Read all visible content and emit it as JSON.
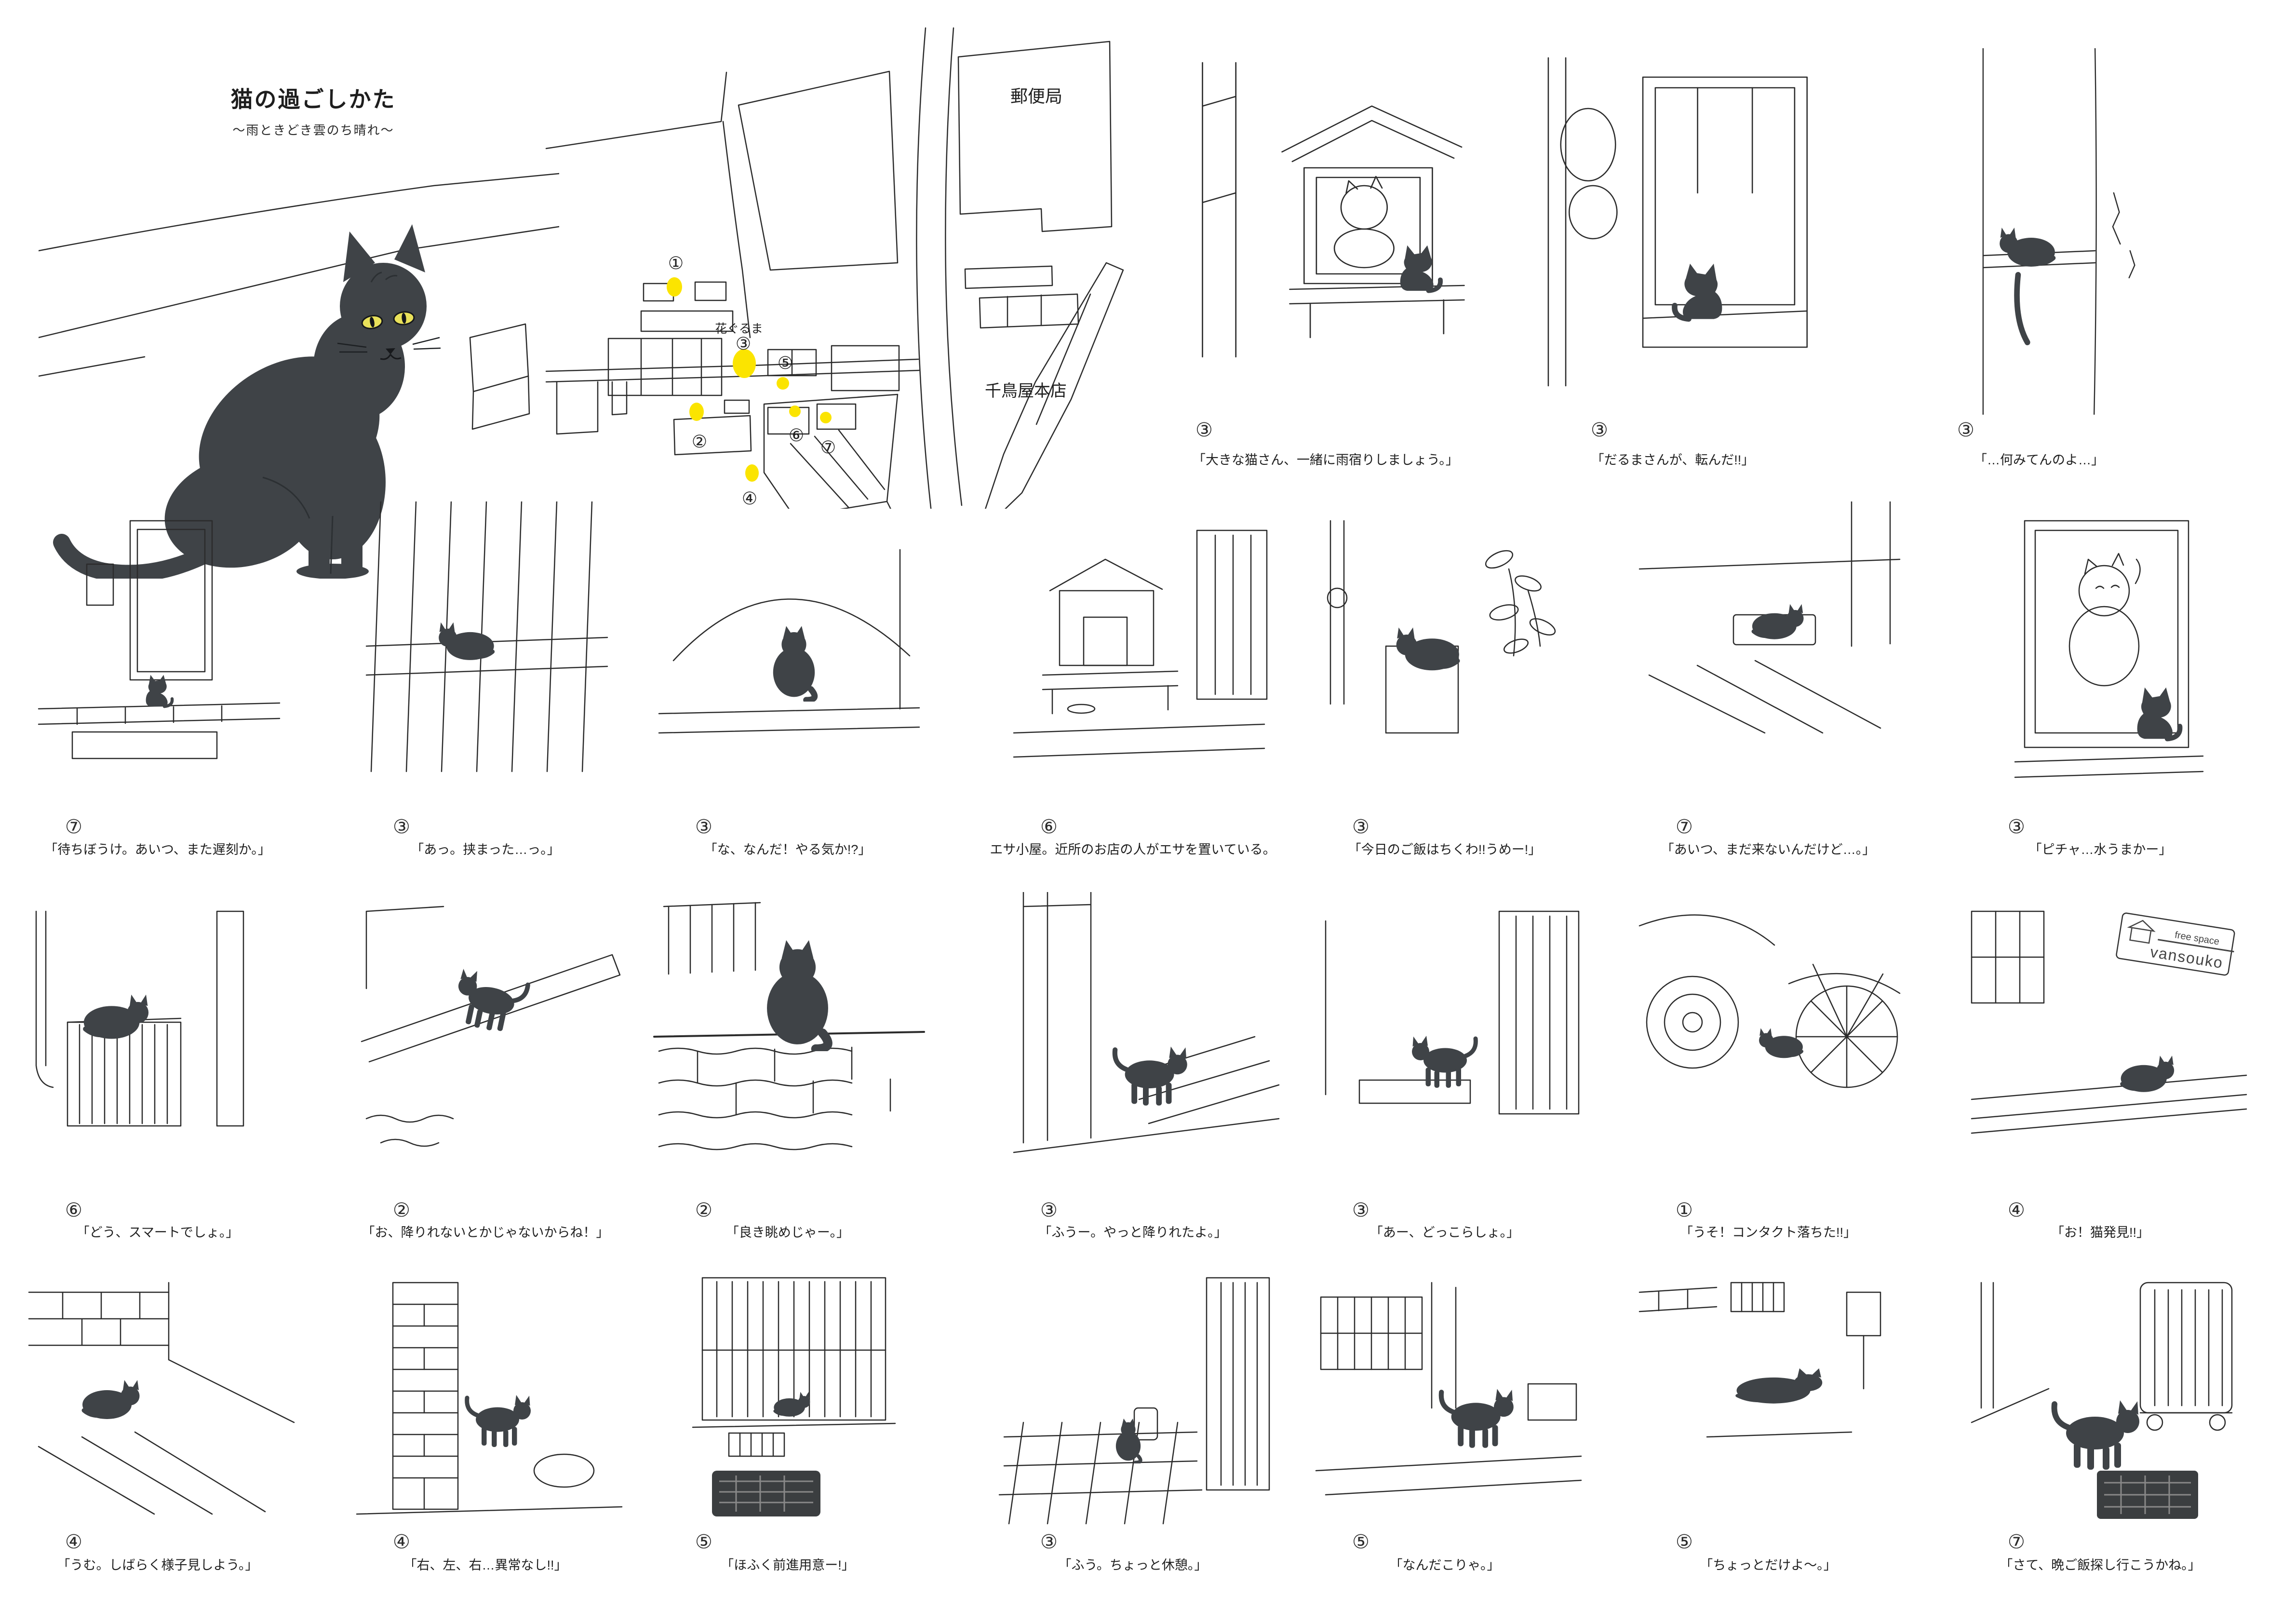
{
  "title": {
    "main": "猫の過ごしかた",
    "subtitle": "〜雨ときどき雲のち晴れ〜"
  },
  "map": {
    "labels": {
      "post_office": "郵便局",
      "hanaguruma": "花ぐるま",
      "chidoriya": "千鳥屋本店"
    },
    "markers": [
      {
        "num": "①"
      },
      {
        "num": "②"
      },
      {
        "num": "③"
      },
      {
        "num": "④"
      },
      {
        "num": "⑤"
      },
      {
        "num": "⑥"
      },
      {
        "num": "⑦"
      }
    ]
  },
  "sign": {
    "line1": "free space",
    "line2": "vansouko"
  },
  "colors": {
    "cat": "#3f4347",
    "marker": "#fbe400",
    "eye": "#e9e15a",
    "line": "#2b2b2b"
  },
  "panels": {
    "row1": [
      {
        "num": "③",
        "caption": "「大きな猫さん、一緒に雨宿りしましょう。」"
      },
      {
        "num": "③",
        "caption": "「だるまさんが、転んだ!!」"
      },
      {
        "num": "③",
        "caption": "「…何みてんのよ…」"
      }
    ],
    "row2": [
      {
        "num": "⑦",
        "caption": "「待ちぼうけ。あいつ、また遅刻か。」"
      },
      {
        "num": "③",
        "caption": "「あっ。挟まった…っ。」"
      },
      {
        "num": "③",
        "caption": "「な、なんだ！やる気か!?」"
      },
      {
        "num": "⑥",
        "caption": "エサ小屋。近所のお店の人がエサを置いている。"
      },
      {
        "num": "③",
        "caption": "「今日のご飯はちくわ!!うめー!」"
      },
      {
        "num": "⑦",
        "caption": "「あいつ、まだ来ないんだけど…。」"
      },
      {
        "num": "③",
        "caption": "「ピチャ…水うまかー」"
      }
    ],
    "row3": [
      {
        "num": "⑥",
        "caption": "「どう、スマートでしょ。」"
      },
      {
        "num": "②",
        "caption": "「お、降りれないとかじゃないからね！」"
      },
      {
        "num": "②",
        "caption": "「良き眺めじゃー。」"
      },
      {
        "num": "③",
        "caption": "「ふうー。やっと降りれたよ。」"
      },
      {
        "num": "③",
        "caption": "「あー、どっこらしょ。」"
      },
      {
        "num": "①",
        "caption": "「うそ！コンタクト落ちた!!」"
      },
      {
        "num": "④",
        "caption": "「お！猫発見!!」"
      }
    ],
    "row4": [
      {
        "num": "④",
        "caption": "「うむ。しばらく様子見しよう。」"
      },
      {
        "num": "④",
        "caption": "「右、左、右…異常なし!!」"
      },
      {
        "num": "⑤",
        "caption": "「ほふく前進用意ー!」"
      },
      {
        "num": "③",
        "caption": "「ふう。ちょっと休憩。」"
      },
      {
        "num": "⑤",
        "caption": "「なんだこりゃ。」"
      },
      {
        "num": "⑤",
        "caption": "「ちょっとだけよ〜。」"
      },
      {
        "num": "⑦",
        "caption": "「さて、晩ご飯探し行こうかね。」"
      }
    ]
  }
}
